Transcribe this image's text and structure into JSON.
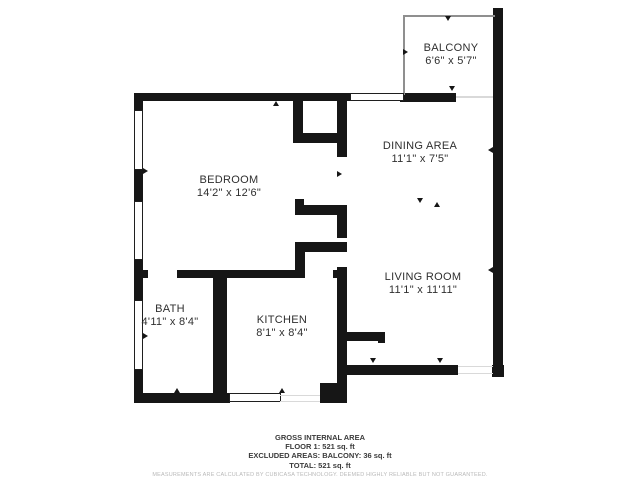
{
  "rooms": [
    {
      "name": "BALCONY",
      "dims": "6'6\" x 5'7\"",
      "cx": 451,
      "top": 42
    },
    {
      "name": "DINING AREA",
      "dims": "11'1\" x 7'5\"",
      "cx": 420,
      "top": 140
    },
    {
      "name": "BEDROOM",
      "dims": "14'2\" x 12'6\"",
      "cx": 229,
      "top": 174
    },
    {
      "name": "LIVING ROOM",
      "dims": "11'1\" x 11'11\"",
      "cx": 423,
      "top": 271
    },
    {
      "name": "BATH",
      "dims": "4'11\" x 8'4\"",
      "cx": 170,
      "top": 303
    },
    {
      "name": "KITCHEN",
      "dims": "8'1\" x 8'4\"",
      "cx": 282,
      "top": 314
    }
  ],
  "footer": {
    "line1": "GROSS INTERNAL AREA",
    "line2": "FLOOR 1: 521 sq. ft",
    "line3": "EXCLUDED AREAS: BALCONY: 36 sq. ft",
    "line4": "TOTAL: 521 sq. ft",
    "disclaimer": "MEASUREMENTS ARE CALCULATED BY CUBICASA TECHNOLOGY. DEEMED HIGHLY RELIABLE BUT NOT GUARANTEED."
  },
  "colors": {
    "wall": "#161616",
    "thin_wall": "#8f8f8f",
    "window_border": "#1f1f1f",
    "threshold": "#d9d9d9",
    "room_text": "#2f2f2f",
    "footer_text": "#3b3b3b",
    "disclaimer_text": "#b9b9b9",
    "background": "#ffffff"
  },
  "geometry": {
    "walls": [
      [
        134,
        93,
        218,
        8
      ],
      [
        400,
        93,
        56,
        9
      ],
      [
        134,
        93,
        9,
        19
      ],
      [
        134,
        168,
        9,
        35
      ],
      [
        134,
        258,
        9,
        44
      ],
      [
        134,
        368,
        9,
        35
      ],
      [
        493,
        8,
        10,
        369
      ],
      [
        134,
        270,
        14,
        8
      ],
      [
        177,
        270,
        128,
        8
      ],
      [
        333,
        270,
        14,
        8
      ],
      [
        213,
        272,
        14,
        130
      ],
      [
        134,
        393,
        96,
        10
      ],
      [
        320,
        383,
        23,
        20
      ],
      [
        337,
        93,
        10,
        64
      ],
      [
        337,
        207,
        10,
        31
      ],
      [
        337,
        267,
        10,
        136
      ],
      [
        293,
        101,
        10,
        42
      ],
      [
        300,
        133,
        47,
        10
      ],
      [
        295,
        199,
        9,
        16
      ],
      [
        295,
        205,
        52,
        10
      ],
      [
        295,
        242,
        52,
        10
      ],
      [
        295,
        242,
        10,
        36
      ],
      [
        345,
        332,
        40,
        9
      ],
      [
        378,
        332,
        7,
        11
      ],
      [
        337,
        365,
        121,
        10
      ],
      [
        492,
        365,
        12,
        12
      ]
    ],
    "thin_walls": [
      [
        403,
        15,
        92,
        2
      ],
      [
        403,
        15,
        2,
        80
      ]
    ],
    "windows": [
      [
        134,
        110,
        9,
        60
      ],
      [
        134,
        201,
        9,
        59
      ],
      [
        134,
        300,
        9,
        70
      ],
      [
        350,
        93,
        54,
        8
      ],
      [
        229,
        393,
        52,
        9
      ]
    ],
    "thresholds": [
      [
        456,
        96,
        37,
        2
      ],
      [
        458,
        366,
        35,
        1
      ],
      [
        458,
        373,
        35,
        1
      ],
      [
        280,
        395,
        40,
        1
      ],
      [
        280,
        401,
        40,
        1
      ]
    ],
    "arrows": [
      {
        "x": 276,
        "y": 104,
        "dir": "up"
      },
      {
        "x": 452,
        "y": 89,
        "dir": "down"
      },
      {
        "x": 448,
        "y": 19,
        "dir": "down"
      },
      {
        "x": 406,
        "y": 52,
        "dir": "right"
      },
      {
        "x": 146,
        "y": 171,
        "dir": "right"
      },
      {
        "x": 146,
        "y": 336,
        "dir": "right"
      },
      {
        "x": 491,
        "y": 150,
        "dir": "left"
      },
      {
        "x": 491,
        "y": 270,
        "dir": "left"
      },
      {
        "x": 340,
        "y": 174,
        "dir": "right"
      },
      {
        "x": 373,
        "y": 361,
        "dir": "down"
      },
      {
        "x": 440,
        "y": 361,
        "dir": "down"
      },
      {
        "x": 420,
        "y": 201,
        "dir": "down"
      },
      {
        "x": 437,
        "y": 205,
        "dir": "up"
      },
      {
        "x": 177,
        "y": 391,
        "dir": "up"
      },
      {
        "x": 282,
        "y": 391,
        "dir": "up"
      }
    ]
  }
}
